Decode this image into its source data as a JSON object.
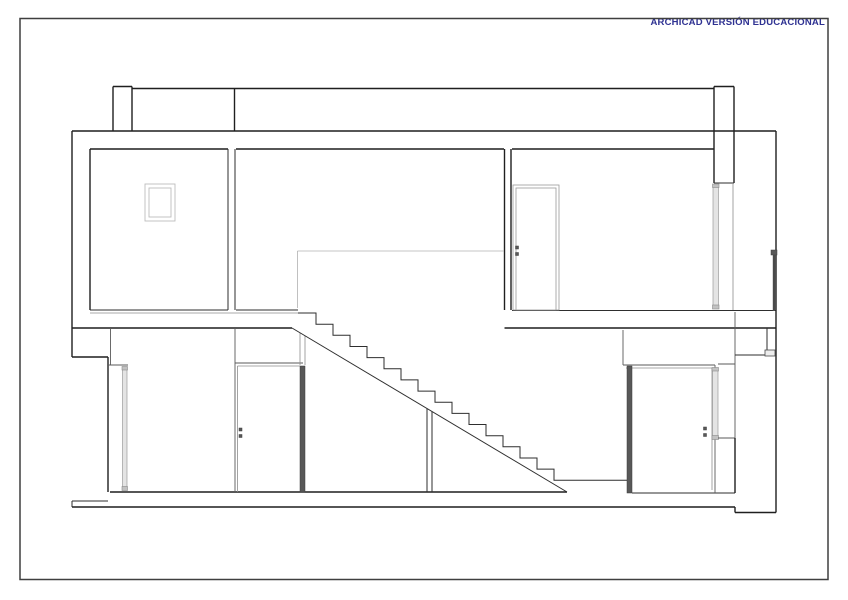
{
  "banner": {
    "text": "ARCHICAD VERSIÓN EDUCACIONAL",
    "color": "#2e3192"
  },
  "page": {
    "background": "#ffffff",
    "frame_color": "#3f3f3f"
  },
  "drawing": {
    "description": "Building cross-section: two storeys, central stair with under-stair closets, sectioned doors and glazing, roof parapets",
    "stair": {
      "treads": 16,
      "tread_px": 17,
      "riser_px": 11.15
    },
    "items": [
      {
        "t": "r",
        "c": "fr",
        "n": "sheet-frame",
        "d": [
          20,
          18.5,
          808,
          561
        ]
      },
      {
        "t": "l",
        "c": "k",
        "n": "parapet-left-cap",
        "d": [
          113,
          86.5,
          132,
          86.5
        ]
      },
      {
        "t": "l",
        "c": "k",
        "n": "parapet-left-outer",
        "d": [
          113,
          86.5,
          113,
          131
        ]
      },
      {
        "t": "l",
        "c": "k",
        "n": "parapet-left-inner",
        "d": [
          132,
          86.5,
          132,
          131
        ]
      },
      {
        "t": "l",
        "c": "k",
        "n": "roof-top-edge",
        "d": [
          132,
          88.5,
          714,
          88.5
        ]
      },
      {
        "t": "l",
        "c": "k",
        "n": "roof-joint-line",
        "d": [
          234.5,
          88.5,
          234.5,
          131
        ]
      },
      {
        "t": "l",
        "c": "k",
        "n": "parapet-right-cap",
        "d": [
          714,
          86.5,
          734,
          86.5
        ]
      },
      {
        "t": "l",
        "c": "k",
        "n": "parapet-right-outer",
        "d": [
          714,
          86.5,
          714,
          183
        ]
      },
      {
        "t": "l",
        "c": "k",
        "n": "parapet-right-inner",
        "d": [
          734,
          86.5,
          734,
          183
        ]
      },
      {
        "t": "l",
        "c": "s",
        "n": "lintel-bottom",
        "d": [
          714,
          183,
          734,
          183
        ]
      },
      {
        "t": "l",
        "c": "k",
        "n": "roof-slab-edge",
        "d": [
          72,
          131,
          776,
          131
        ]
      },
      {
        "t": "l",
        "c": "k",
        "n": "ceiling-left-room",
        "d": [
          90,
          149,
          228,
          149
        ]
      },
      {
        "t": "l",
        "c": "k",
        "n": "ceiling-middle",
        "d": [
          236,
          149,
          504,
          149
        ]
      },
      {
        "t": "l",
        "c": "k",
        "n": "ceiling-right-room",
        "d": [
          512,
          149,
          714,
          149
        ]
      },
      {
        "t": "l",
        "c": "k",
        "n": "wall-left-outer",
        "d": [
          72,
          131,
          72,
          357
        ]
      },
      {
        "t": "l",
        "c": "k",
        "n": "wall-left-inner",
        "d": [
          90,
          149,
          90,
          310
        ]
      },
      {
        "t": "l",
        "c": "s",
        "n": "wall-mid-left-face",
        "d": [
          228,
          149,
          228,
          310
        ]
      },
      {
        "t": "l",
        "c": "s",
        "n": "wall-mid-right-face",
        "d": [
          235,
          149,
          235,
          310
        ]
      },
      {
        "t": "l",
        "c": "k",
        "n": "wall-upper-right-left-face",
        "d": [
          504.5,
          149,
          504.5,
          310
        ]
      },
      {
        "t": "l",
        "c": "k",
        "n": "wall-upper-right-right-face",
        "d": [
          511,
          149,
          511,
          310
        ]
      },
      {
        "t": "l",
        "c": "t",
        "n": "glazing-frame-line",
        "d": [
          733,
          183,
          733,
          311
        ]
      },
      {
        "t": "l",
        "c": "s",
        "n": "floor-left-room",
        "d": [
          90,
          310,
          228,
          310
        ]
      },
      {
        "t": "l",
        "c": "s",
        "n": "floor-middle",
        "d": [
          236,
          310,
          298,
          310
        ]
      },
      {
        "t": "l",
        "c": "s",
        "n": "floor-right-terrace",
        "d": [
          512,
          310.5,
          776,
          310.5
        ]
      },
      {
        "t": "l",
        "c": "t",
        "n": "slab-top-left",
        "d": [
          90,
          313,
          298,
          313
        ]
      },
      {
        "t": "l",
        "c": "k",
        "n": "slab-bottom-left",
        "d": [
          72,
          328,
          292,
          328
        ]
      },
      {
        "t": "l",
        "c": "k",
        "n": "slab-bottom-right",
        "d": [
          504.5,
          328,
          776,
          328
        ]
      },
      {
        "t": "l",
        "c": "k",
        "n": "wall-right-outer",
        "d": [
          776,
          131,
          776,
          512.5
        ]
      },
      {
        "t": "r",
        "c": "d",
        "n": "railing-cap",
        "d": [
          771,
          250,
          6,
          5
        ]
      },
      {
        "t": "l",
        "c": "dl",
        "n": "railing-glass",
        "d": [
          774,
          255,
          774,
          311
        ]
      },
      {
        "t": "l",
        "c": "x",
        "n": "stair-opening-line-h",
        "d": [
          297.5,
          251,
          504,
          251
        ]
      },
      {
        "t": "l",
        "c": "x",
        "n": "stair-opening-line-v",
        "d": [
          297.5,
          251,
          297.5,
          308
        ]
      },
      {
        "t": "r",
        "c": "w",
        "n": "door-upper-frame",
        "d": [
          513,
          185,
          46,
          125
        ]
      },
      {
        "t": "r",
        "c": "w",
        "n": "door-upper-leaf",
        "d": [
          516,
          188,
          40,
          122
        ]
      },
      {
        "t": "r",
        "c": "d",
        "n": "door-upper-handle-a",
        "d": [
          515.5,
          246,
          3,
          3
        ]
      },
      {
        "t": "r",
        "c": "d",
        "n": "door-upper-handle-b",
        "d": [
          515.5,
          252.5,
          3,
          3
        ]
      },
      {
        "t": "r",
        "c": "f",
        "n": "window-outer",
        "d": [
          145,
          184,
          30,
          37
        ]
      },
      {
        "t": "r",
        "c": "f",
        "n": "window-inner",
        "d": [
          149,
          188,
          22,
          29
        ]
      },
      {
        "t": "r",
        "c": "g",
        "n": "glazing-right-glass",
        "d": [
          713,
          185,
          5.5,
          123
        ]
      },
      {
        "t": "r",
        "c": "gc",
        "n": "glazing-right-cap-top",
        "d": [
          712.5,
          184,
          6.5,
          3.5
        ]
      },
      {
        "t": "r",
        "c": "gc",
        "n": "glazing-right-cap-bottom",
        "d": [
          712.5,
          305,
          6.5,
          4
        ]
      },
      {
        "t": "l",
        "c": "k",
        "n": "wall-left-stub-bottom",
        "d": [
          72,
          357,
          108,
          357
        ]
      },
      {
        "t": "l",
        "c": "k",
        "n": "wall-lower-left-outer",
        "d": [
          108,
          357,
          108,
          492
        ]
      },
      {
        "t": "l",
        "c": "m",
        "n": "wall-lower-left-inner",
        "d": [
          110.5,
          328,
          110.5,
          365
        ]
      },
      {
        "t": "l",
        "c": "m",
        "n": "door-left-head",
        "d": [
          108,
          365,
          128,
          365
        ]
      },
      {
        "t": "r",
        "c": "g",
        "n": "door-left-glass",
        "d": [
          122.5,
          367.5,
          4.5,
          120
        ]
      },
      {
        "t": "r",
        "c": "gc",
        "n": "door-left-cap-top",
        "d": [
          122,
          366.5,
          5.5,
          3.5
        ]
      },
      {
        "t": "r",
        "c": "gc",
        "n": "door-left-cap-bottom",
        "d": [
          122,
          486.5,
          5.5,
          4
        ]
      },
      {
        "t": "l",
        "c": "k",
        "n": "floor-main",
        "d": [
          110,
          492,
          567,
          492
        ]
      },
      {
        "t": "l",
        "c": "s",
        "n": "floor-stair-landing",
        "d": [
          571,
          480.3,
          627,
          480.3
        ]
      },
      {
        "t": "l",
        "c": "s",
        "n": "floor-right-room",
        "d": [
          632,
          493,
          735,
          493
        ]
      },
      {
        "t": "l",
        "c": "s",
        "n": "slab-ledge-left",
        "d": [
          72,
          501,
          108,
          501
        ]
      },
      {
        "t": "l",
        "c": "s",
        "n": "slab-edge-left",
        "d": [
          72,
          501,
          72,
          507
        ]
      },
      {
        "t": "l",
        "c": "k",
        "n": "slab-bottom",
        "d": [
          72,
          507,
          735,
          507
        ]
      },
      {
        "t": "l",
        "c": "k",
        "n": "slab-step-right-v",
        "d": [
          735,
          507,
          735,
          512.5
        ]
      },
      {
        "t": "l",
        "c": "k",
        "n": "slab-step-right-h",
        "d": [
          735,
          512.5,
          776,
          512.5
        ]
      },
      {
        "t": "l",
        "c": "m",
        "n": "wall-above-door-mid",
        "d": [
          235,
          328,
          235,
          363
        ]
      },
      {
        "t": "l",
        "c": "m",
        "n": "door-mid-head-outer",
        "d": [
          235,
          363,
          303,
          363
        ]
      },
      {
        "t": "l",
        "c": "t",
        "n": "door-mid-head-inner",
        "d": [
          237.5,
          366,
          300,
          366
        ]
      },
      {
        "t": "l",
        "c": "m",
        "n": "door-mid-frame-left",
        "d": [
          235,
          363,
          235,
          492
        ]
      },
      {
        "t": "l",
        "c": "t",
        "n": "door-mid-frame-inner",
        "d": [
          237.5,
          366,
          237.5,
          492
        ]
      },
      {
        "t": "l",
        "c": "t",
        "n": "wall-mid2-face-a",
        "d": [
          300,
          333,
          300,
          365
        ]
      },
      {
        "t": "l",
        "c": "t",
        "n": "wall-mid2-face-b",
        "d": [
          305,
          336,
          305,
          365
        ]
      },
      {
        "t": "r",
        "c": "d",
        "n": "door-mid-jamb-bar",
        "d": [
          300,
          366,
          5,
          126
        ]
      },
      {
        "t": "r",
        "c": "d",
        "n": "door-mid-handle-a",
        "d": [
          239,
          428,
          3,
          3
        ]
      },
      {
        "t": "r",
        "c": "d",
        "n": "door-mid-handle-b",
        "d": [
          239,
          434.5,
          3,
          3
        ]
      },
      {
        "t": "p",
        "c": "s",
        "n": "stair-steps",
        "d": [
          298,
          313,
          316,
          313,
          316,
          324.2,
          333,
          324.2,
          333,
          335.3,
          350,
          335.3,
          350,
          346.5,
          367,
          346.5,
          367,
          357.6,
          384,
          357.6,
          384,
          368.8,
          401,
          368.8,
          401,
          379.9,
          418,
          379.9,
          418,
          391.1,
          435,
          391.1,
          435,
          402.2,
          452,
          402.2,
          452,
          413.4,
          469,
          413.4,
          469,
          424.5,
          486,
          424.5,
          486,
          435.7,
          503,
          435.7,
          503,
          446.8,
          520,
          446.8,
          520,
          458,
          537,
          458,
          537,
          469.1,
          554,
          469.1,
          554,
          480.3,
          571,
          480.3
        ]
      },
      {
        "t": "l",
        "c": "s",
        "n": "stair-soffit",
        "d": [
          292,
          328,
          567,
          492
        ]
      },
      {
        "t": "l",
        "c": "s",
        "n": "understair-partition-a",
        "d": [
          427,
          408.5,
          427,
          492
        ]
      },
      {
        "t": "l",
        "c": "s",
        "n": "understair-partition-b",
        "d": [
          432,
          411.5,
          432,
          492
        ]
      },
      {
        "t": "l",
        "c": "m",
        "n": "wall-above-door-right",
        "d": [
          623,
          330,
          623,
          365
        ]
      },
      {
        "t": "l",
        "c": "m",
        "n": "door-right-head-outer",
        "d": [
          623,
          365,
          715,
          365
        ]
      },
      {
        "t": "l",
        "c": "t",
        "n": "door-right-head-inner",
        "d": [
          626,
          368,
          712,
          368
        ]
      },
      {
        "t": "r",
        "c": "d",
        "n": "door-right-jamb-bar",
        "d": [
          627,
          366,
          5,
          127
        ]
      },
      {
        "t": "l",
        "c": "m",
        "n": "door-right-frame-right",
        "d": [
          715,
          365,
          715,
          493
        ]
      },
      {
        "t": "l",
        "c": "t",
        "n": "door-right-frame-inner",
        "d": [
          712,
          368,
          712,
          490
        ]
      },
      {
        "t": "r",
        "c": "d",
        "n": "door-right-handle-a",
        "d": [
          703.5,
          427,
          3,
          3
        ]
      },
      {
        "t": "r",
        "c": "d",
        "n": "door-right-handle-b",
        "d": [
          703.5,
          433.5,
          3,
          3
        ]
      },
      {
        "t": "r",
        "c": "g",
        "n": "door-right-glass",
        "d": [
          712.5,
          368.5,
          5.5,
          68
        ]
      },
      {
        "t": "r",
        "c": "gc",
        "n": "door-right-glass-cap-top",
        "d": [
          712,
          367.5,
          6.5,
          3.5
        ]
      },
      {
        "t": "r",
        "c": "gc",
        "n": "door-right-glass-cap-bottom",
        "d": [
          712,
          435.5,
          6.5,
          4
        ]
      },
      {
        "t": "l",
        "c": "m",
        "n": "wall-right-lintel",
        "d": [
          718,
          364,
          735,
          364
        ]
      },
      {
        "t": "l",
        "c": "m",
        "n": "wall-right-sill-line",
        "d": [
          718,
          438,
          735,
          438
        ]
      },
      {
        "t": "l",
        "c": "m",
        "n": "wall-right-inner-upper",
        "d": [
          735,
          312,
          735,
          438
        ]
      },
      {
        "t": "l",
        "c": "k",
        "n": "wall-right-inner-lower",
        "d": [
          735,
          438,
          735,
          493
        ]
      },
      {
        "t": "l",
        "c": "s",
        "n": "wall-right-notch-h",
        "d": [
          735,
          355,
          765,
          355
        ]
      },
      {
        "t": "l",
        "c": "s",
        "n": "wall-right-notch-v",
        "d": [
          767,
          328,
          767,
          355
        ]
      },
      {
        "t": "r",
        "c": "si",
        "n": "window-sill-right",
        "d": [
          765,
          350,
          10,
          6
        ]
      }
    ]
  }
}
